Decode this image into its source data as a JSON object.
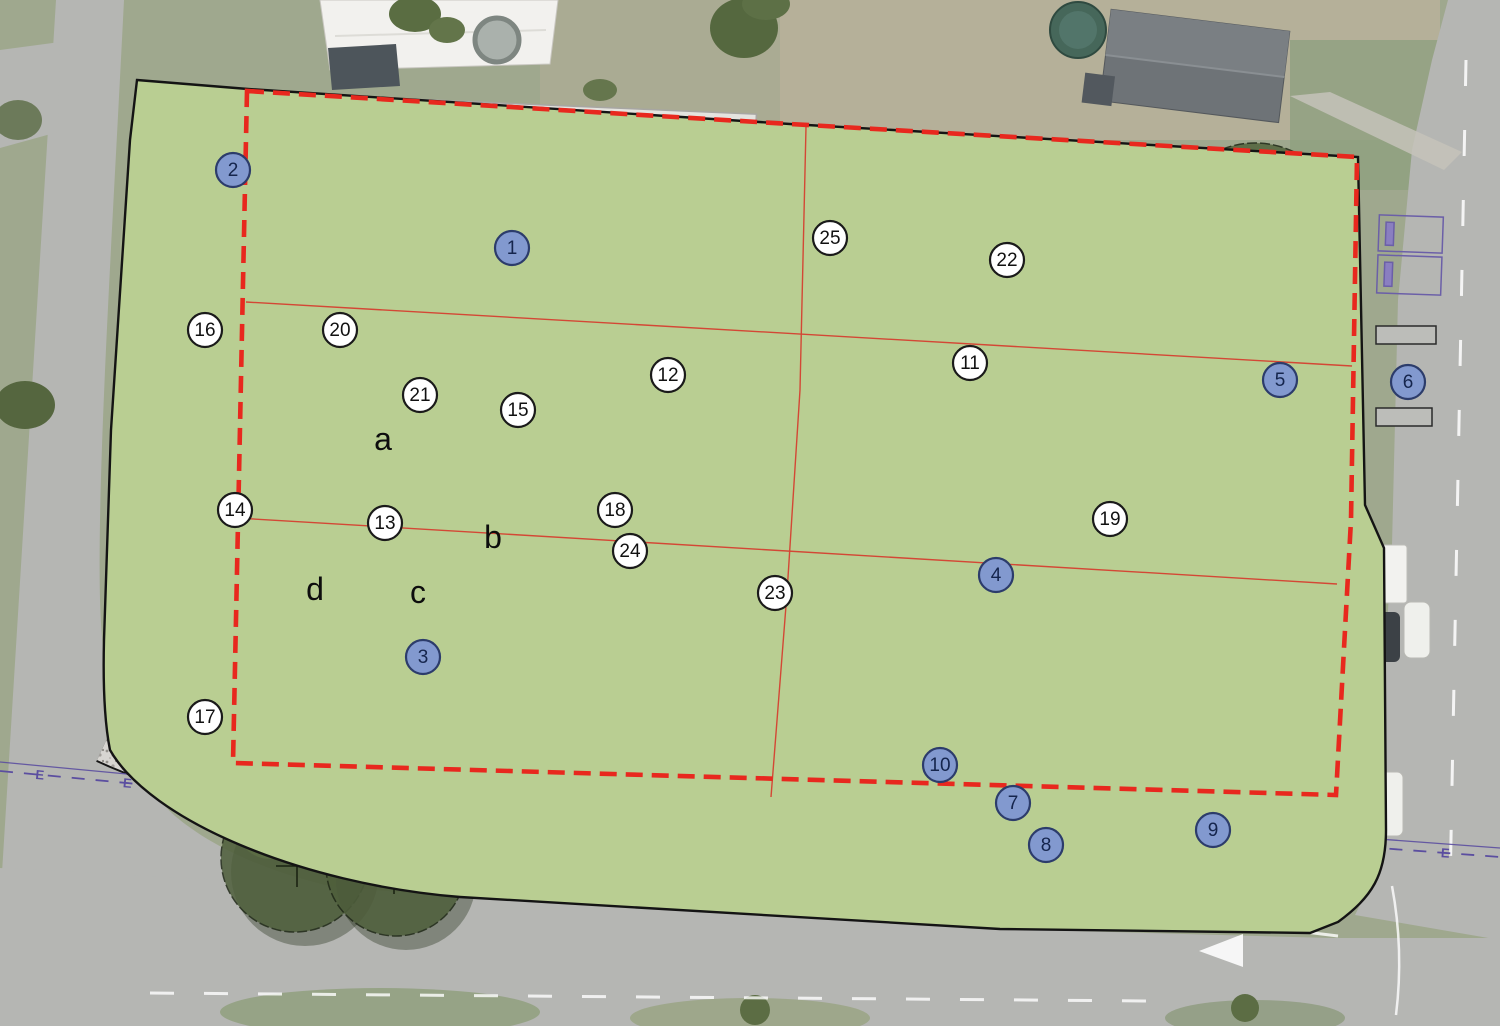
{
  "plan": {
    "title": "park-concept-site-plan",
    "markers": [
      {
        "n": "1",
        "kind": "primary",
        "x": 512,
        "y": 248
      },
      {
        "n": "2",
        "kind": "primary",
        "x": 233,
        "y": 170
      },
      {
        "n": "3",
        "kind": "primary",
        "x": 423,
        "y": 657
      },
      {
        "n": "4",
        "kind": "primary",
        "x": 996,
        "y": 575
      },
      {
        "n": "5",
        "kind": "primary",
        "x": 1280,
        "y": 380
      },
      {
        "n": "6",
        "kind": "primary",
        "x": 1408,
        "y": 382
      },
      {
        "n": "7",
        "kind": "primary",
        "x": 1013,
        "y": 803
      },
      {
        "n": "8",
        "kind": "primary",
        "x": 1046,
        "y": 845
      },
      {
        "n": "9",
        "kind": "primary",
        "x": 1213,
        "y": 830
      },
      {
        "n": "10",
        "kind": "primary",
        "x": 940,
        "y": 765
      },
      {
        "n": "11",
        "kind": "secondary",
        "x": 970,
        "y": 363
      },
      {
        "n": "12",
        "kind": "secondary",
        "x": 668,
        "y": 375
      },
      {
        "n": "13",
        "kind": "secondary",
        "x": 385,
        "y": 523
      },
      {
        "n": "14",
        "kind": "secondary",
        "x": 235,
        "y": 510
      },
      {
        "n": "15",
        "kind": "secondary",
        "x": 518,
        "y": 410
      },
      {
        "n": "16",
        "kind": "secondary",
        "x": 205,
        "y": 330
      },
      {
        "n": "17",
        "kind": "secondary",
        "x": 205,
        "y": 717
      },
      {
        "n": "18",
        "kind": "secondary",
        "x": 615,
        "y": 510
      },
      {
        "n": "19",
        "kind": "secondary",
        "x": 1110,
        "y": 519
      },
      {
        "n": "20",
        "kind": "secondary",
        "x": 340,
        "y": 330
      },
      {
        "n": "21",
        "kind": "secondary",
        "x": 420,
        "y": 395
      },
      {
        "n": "22",
        "kind": "secondary",
        "x": 1007,
        "y": 260
      },
      {
        "n": "23",
        "kind": "secondary",
        "x": 775,
        "y": 593
      },
      {
        "n": "24",
        "kind": "secondary",
        "x": 630,
        "y": 551
      },
      {
        "n": "25",
        "kind": "secondary",
        "x": 830,
        "y": 238
      }
    ],
    "zone_labels": [
      {
        "label": "a",
        "x": 383,
        "y": 439
      },
      {
        "label": "b",
        "x": 493,
        "y": 537
      },
      {
        "label": "c",
        "x": 418,
        "y": 592
      },
      {
        "label": "d",
        "x": 315,
        "y": 589
      }
    ],
    "symbols": {
      "utility_line": "E",
      "fence_mark": "×"
    },
    "colors": {
      "primary_marker_fill": "#8299cf",
      "primary_marker_border": "#2c3c6b",
      "primary_marker_text": "#15254d",
      "secondary_marker_fill": "#ffffff",
      "secondary_marker_border": "#1a1a1a",
      "secondary_marker_text": "#111111",
      "boundary_red": "#e8281e",
      "section_line_red": "#d63c2e",
      "court_blue": "#46708f",
      "playground_sand": "#f3cba2",
      "park_green": "#b9ce92",
      "utility_purple": "#5b4ea0",
      "fence_purple": "#4a3f9e",
      "gravel_grey": "#d7d5d1"
    },
    "utility_line_path": [
      [
        0,
        771
      ],
      [
        190,
        789
      ],
      [
        420,
        805
      ],
      [
        800,
        815
      ],
      [
        1150,
        831
      ],
      [
        1500,
        857
      ]
    ],
    "fence_marks_vertical_x": 233,
    "fence_marks_vertical_ys": [
      108,
      146,
      186,
      228,
      266,
      294
    ],
    "fence_marks_horizontal": [
      [
        254,
        310
      ],
      [
        283,
        311
      ]
    ]
  }
}
